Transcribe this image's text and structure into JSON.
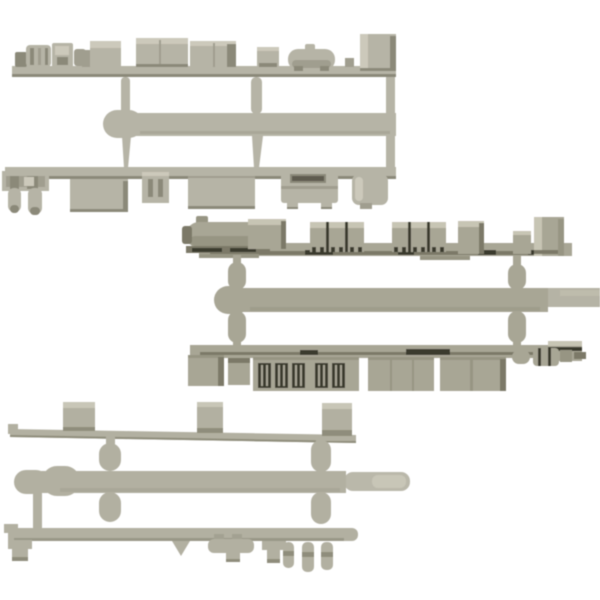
{
  "page": {
    "background": "#ffffff",
    "description": "Product photo of three gray-green plastic model sprues (runners) holding N-scale train underfloor equipment parts: tanks, compressors, equipment boxes, battery grilles and pegs, arranged diagonally on a white background"
  },
  "colors": {
    "sprue1": {
      "base": "#b6b4a6",
      "light": "#ccc9bb",
      "mid": "#a09e8f",
      "shade": "#8b8979",
      "dark": "#5e5c50"
    },
    "sprue2": {
      "base": "#a8a695",
      "light": "#c7c5b4",
      "mid": "#979583",
      "shade": "#7b7968",
      "dark": "#3b3a2e"
    },
    "sprue3": {
      "base": "#b2b0a1",
      "light": "#c8c6b7",
      "mid": "#a3a192",
      "shade": "#8f8d7c",
      "dark": "#55544a"
    }
  },
  "sprues": [
    {
      "id": "sprue-top",
      "label": "upper parts runner with compressor, tank and equipment boxes"
    },
    {
      "id": "sprue-middle",
      "label": "middle parts runner with ribbed equipment boxes and battery grilles"
    },
    {
      "id": "sprue-bottom",
      "label": "lower parts runner with long floor bars and small pegs"
    }
  ]
}
